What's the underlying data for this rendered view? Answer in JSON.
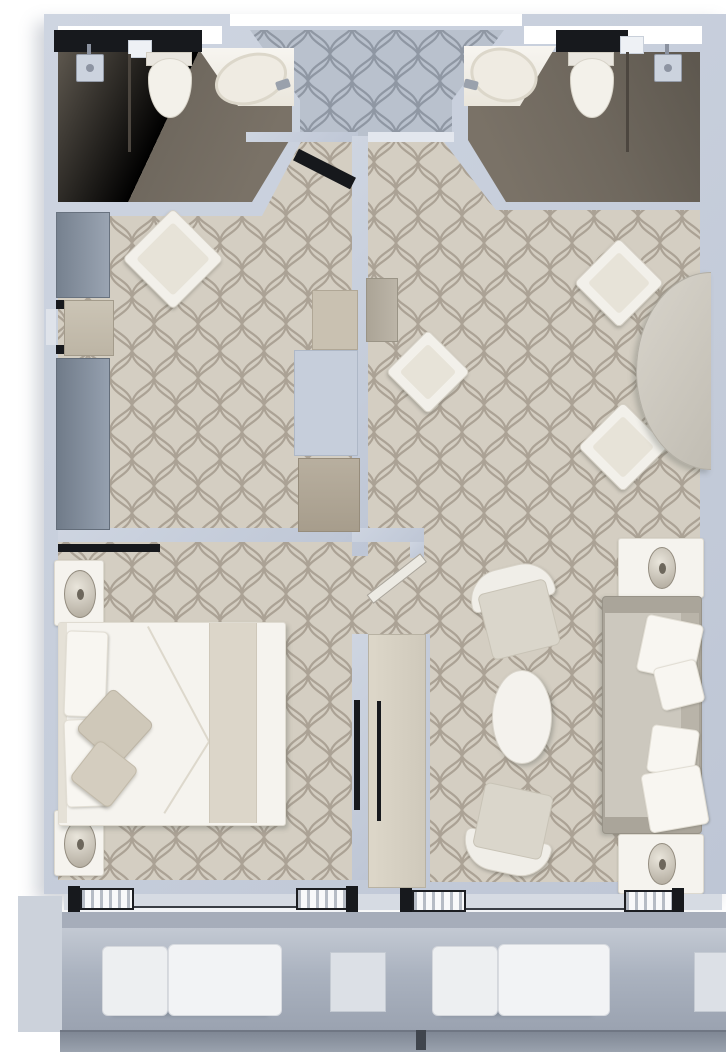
{
  "meta": {
    "type": "architectural-floor-plan",
    "title": "Suite floor plan (top-down render)",
    "visible_text": "none"
  },
  "palette": {
    "wall": "#c6cedc",
    "tile_beige_bg": "#d4cec2",
    "tile_beige_line": "#9d9385",
    "tile_blue_bg": "#b9c1cd",
    "tile_blue_line": "#848c99",
    "bathroom_floor_dark": "#6b645a",
    "black_detail": "#17191d",
    "white_furniture": "#f5f3ee",
    "sofa_body": "#ccc8be",
    "balcony_floor": "#a8b0bd",
    "railing": "#8a92a0"
  },
  "rooms": {
    "bathroom_left": {
      "fixtures": [
        "shower-head",
        "glass-partition",
        "toilet",
        "vanity-counter",
        "sink",
        "black-counter-strip"
      ]
    },
    "bathroom_right": {
      "fixtures": [
        "vanity-counter",
        "sink",
        "toilet",
        "glass-partition",
        "shower-head",
        "black-counter-strip"
      ]
    },
    "entry_hall": {
      "features": [
        "blue-mosaic-tile",
        "open-entry-door"
      ]
    },
    "dressing_area": {
      "furniture": [
        "wardrobe-upper",
        "accent-armchair",
        "wall-niche",
        "wardrobe-lower",
        "cabinet",
        "utility-shaft",
        "closet"
      ]
    },
    "bedroom": {
      "furniture": [
        "nightstand-top",
        "nightstand-bottom",
        "double-bed",
        "bed-pillows",
        "bed-runner",
        "decor-pillows",
        "wall-tv",
        "closet-strip",
        "entry-door"
      ]
    },
    "living_room": {
      "furniture": [
        "console-desk",
        "desk-chair",
        "dining-chair-top",
        "dining-chair-bottom",
        "dining-table-halfoval",
        "side-table-lamp-top",
        "sofa",
        "sofa-pillows",
        "coffee-table",
        "armchair-top",
        "armchair-bottom",
        "side-table-lamp-bottom",
        "tv-credenza"
      ]
    },
    "balcony": {
      "furniture": [
        "lounge-chair-left",
        "side-table-left",
        "lounge-chair-right",
        "side-table-right",
        "railing",
        "sliding-door-sills"
      ]
    }
  }
}
